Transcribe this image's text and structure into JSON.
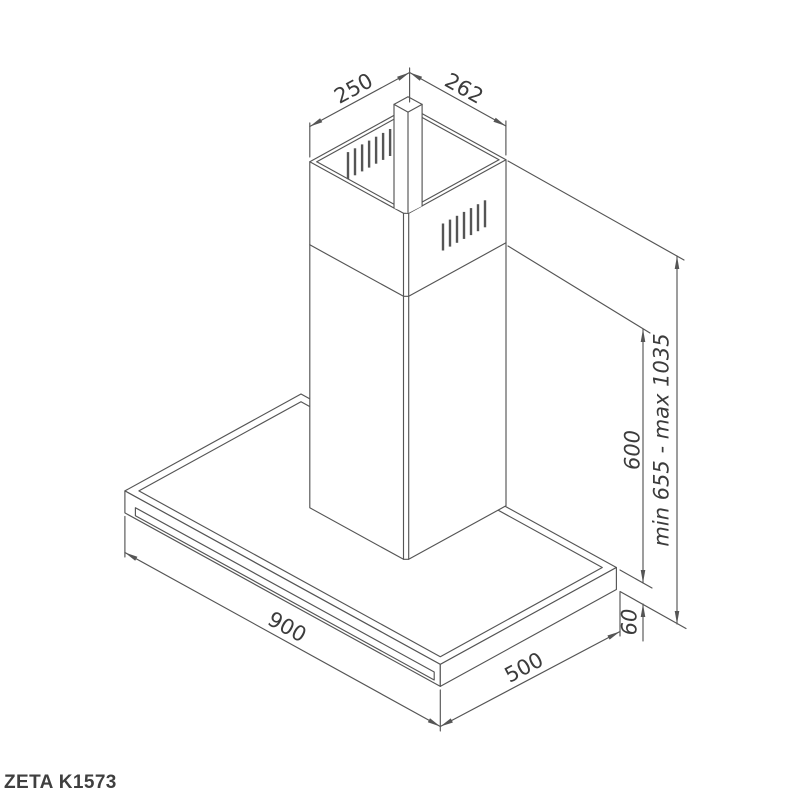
{
  "drawing": {
    "dim_chimney_width": "250",
    "dim_chimney_depth": "262",
    "dim_body_width": "900",
    "dim_body_depth": "500",
    "dim_lower_chimney_height": "600",
    "dim_overall_height_range": "min 655 - max 1035",
    "dim_body_height": "60"
  },
  "footer": {
    "model_label": "ZETA K1573"
  }
}
